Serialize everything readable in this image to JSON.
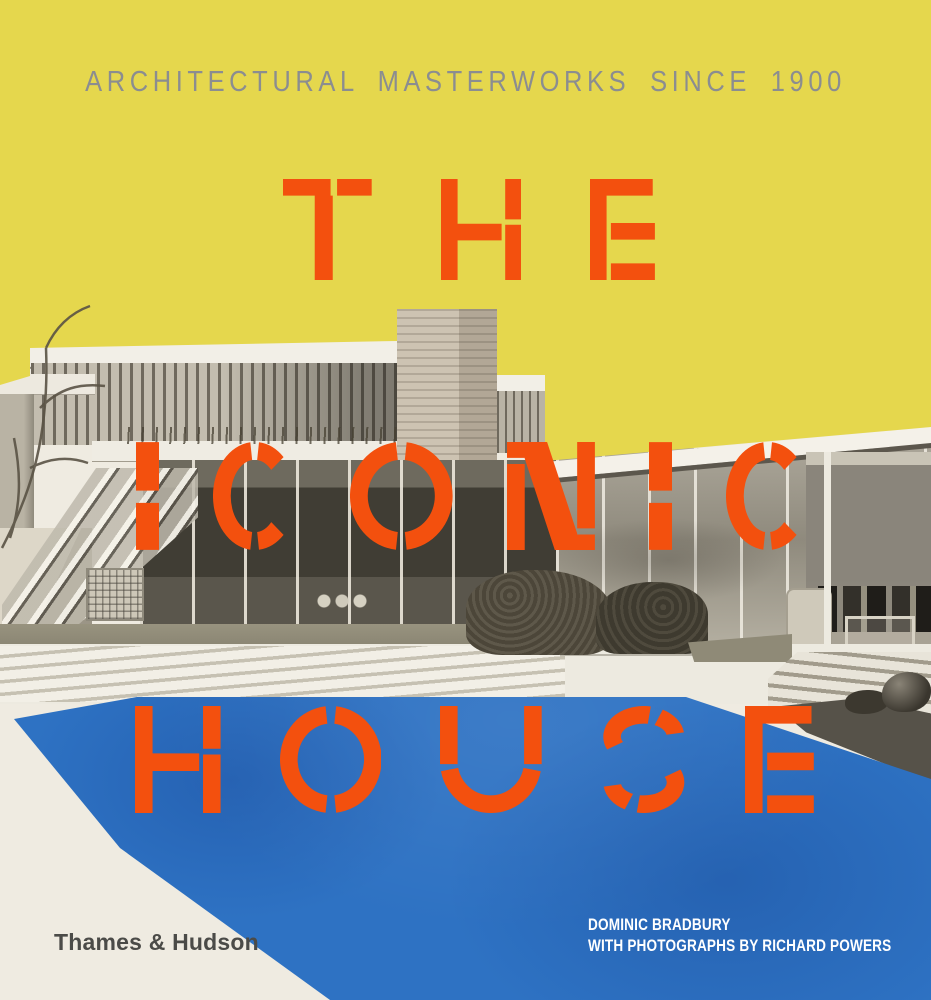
{
  "cover": {
    "tagline": "ARCHITECTURAL MASTERWORKS SINCE 1900",
    "title": {
      "line1": "THE",
      "line2": "ICONIC",
      "line3": "HOUSE"
    },
    "publisher_logo": "Thames & Hudson",
    "credits": {
      "line1": "DOMINIC BRADBURY",
      "line2": "WITH PHOTOGRAPHS BY RICHARD POWERS"
    },
    "colors": {
      "yellow": "#E5D74D",
      "orange": "#F3500E",
      "pool_blue": "#2E72C3",
      "paper": "#EFEBE1",
      "tagline_gray": "#8B8D90",
      "publisher_gray": "#4B4B48",
      "credits_white": "#FFFFFF"
    }
  }
}
